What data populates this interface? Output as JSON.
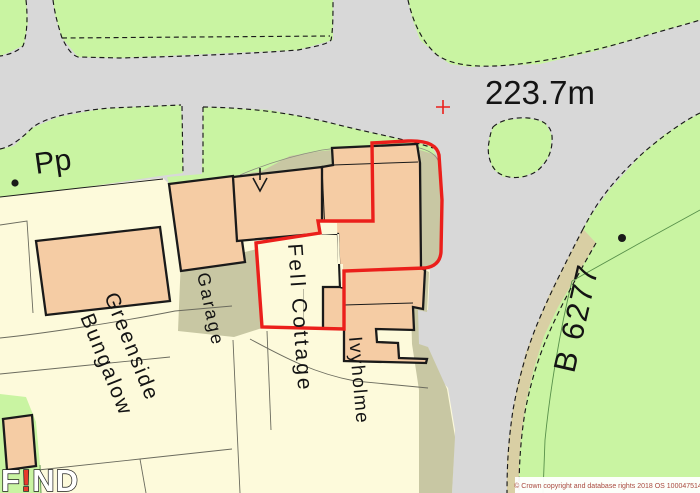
{
  "map": {
    "labels": {
      "spot_height": "223.7m",
      "pp": "Pp",
      "greenside_1": "Greenside",
      "greenside_2": "Bungalow",
      "garage": "Garage",
      "fell_cottage": "Fell Cottage",
      "ivyholme": "Ivyholme",
      "road_number": "B 6277",
      "copyright": "© Crown copyright and database rights 2018 OS 100047514",
      "watermark": {
        "f": "F",
        "bang": "!",
        "nd": "ND"
      }
    },
    "colors": {
      "road_grey": "#D8D8D8",
      "verge_green": "#C9F4A2",
      "cream": "#FDFADB",
      "building_peach": "#F5CCA4",
      "khaki": "#C8C7A3",
      "tan_strip": "#D9CFA4",
      "boundary_red": "#EB1F1B",
      "copyright_text": "#A94A3F",
      "watermark_bang": "#E8392C",
      "copyright_bg": "#FFFFFF"
    }
  }
}
